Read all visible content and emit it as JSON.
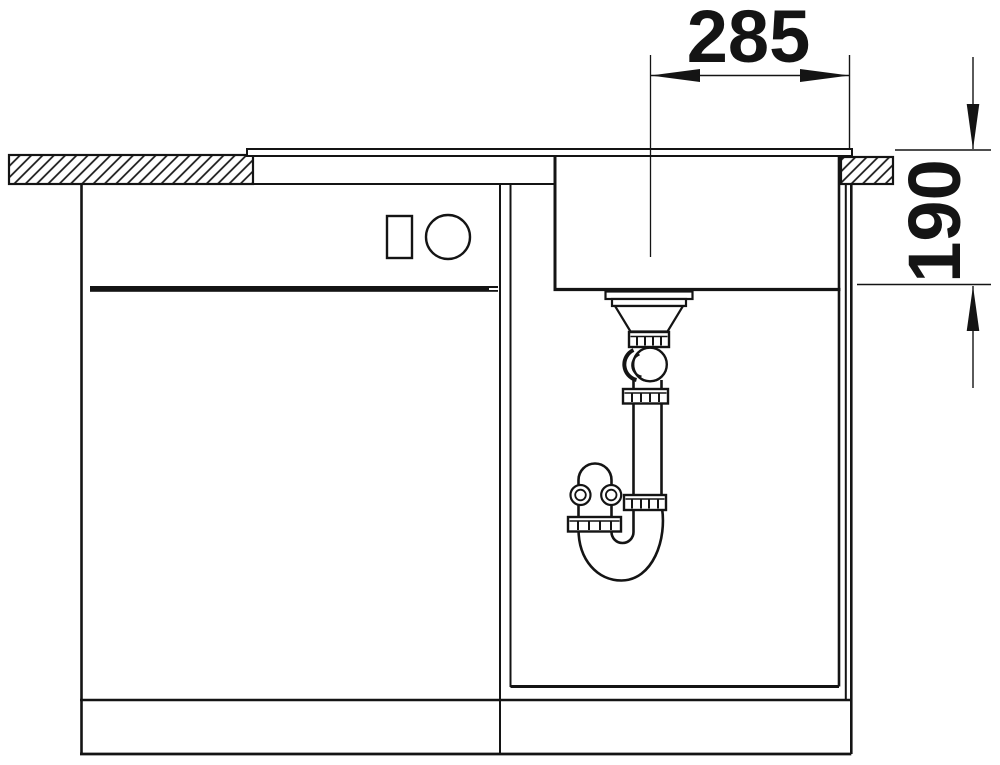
{
  "drawing": {
    "background_color": "#ffffff",
    "line_color": "#141414",
    "dimensions": {
      "horizontal": {
        "label": "285"
      },
      "vertical": {
        "label": "190"
      }
    }
  }
}
